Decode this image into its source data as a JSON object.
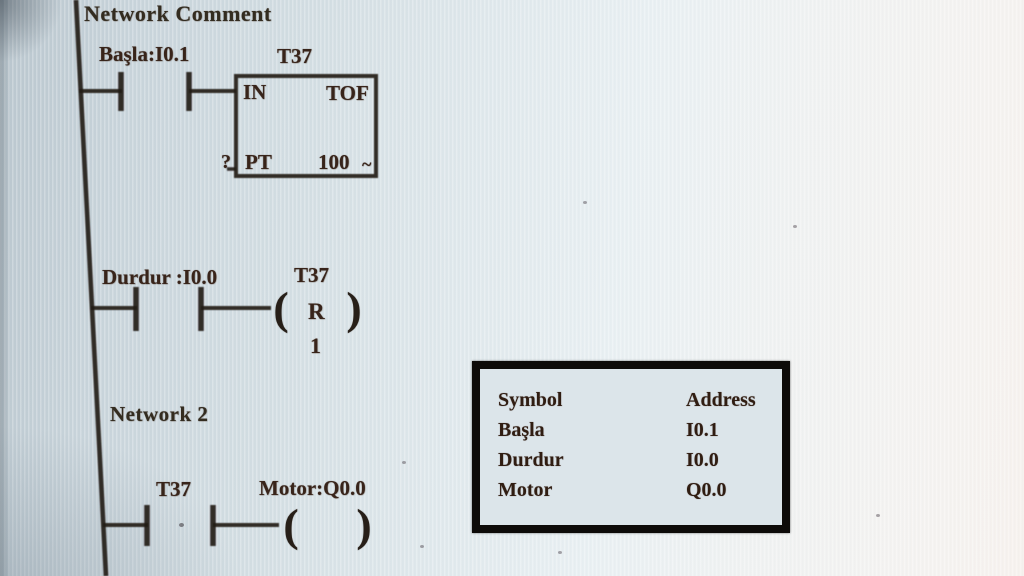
{
  "colors": {
    "wire": "#241d17",
    "label_text": "#38241a",
    "comment_text": "#332c20",
    "table_text": "#301d12",
    "table_border": "#0d0b09",
    "table_background": "#dce5ea",
    "screen_left": "#b8c5cd",
    "screen_right": "#f7f2ee"
  },
  "network1": {
    "comment": "Network Comment",
    "contact_label": "Başla:I0.1",
    "timer": {
      "name": "T37",
      "in_label": "IN",
      "type_label": "TOF",
      "pt_label": "PT",
      "pt_operand": "?",
      "preset": "100",
      "preset_suffix": "~"
    }
  },
  "reset_rung": {
    "contact_label": "Durdur :I0.0",
    "coil_name": "T37",
    "coil_letter": "R",
    "coil_operand": "1",
    "open_paren": "(",
    "close_paren": ")"
  },
  "network2": {
    "label": "Network 2",
    "contact_label": "T37",
    "coil_label": "Motor:Q0.0",
    "open_paren": "(",
    "close_paren": ")"
  },
  "symbol_table": {
    "headers": {
      "symbol": "Symbol",
      "address": "Address"
    },
    "rows": [
      {
        "symbol": "Başla",
        "address": "I0.1"
      },
      {
        "symbol": "Durdur",
        "address": "I0.0"
      },
      {
        "symbol": "Motor",
        "address": "Q0.0"
      }
    ]
  }
}
